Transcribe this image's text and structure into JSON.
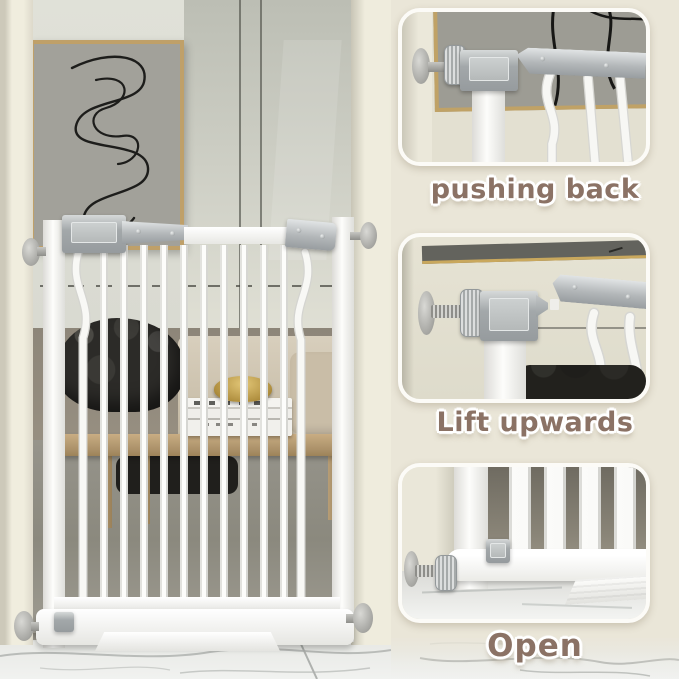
{
  "steps": [
    {
      "id": "pushing-back",
      "label": "pushing back"
    },
    {
      "id": "lift-upwards",
      "label": "Lift upwards"
    },
    {
      "id": "open",
      "label": "Open"
    }
  ],
  "colors": {
    "page_background": "#eae6d8",
    "label_text": "#8b7265",
    "label_outline": "#ffffff",
    "panel_border": "#fcfbf7",
    "gate_white": "#f8f8f5",
    "hardware_gray": "#aab0b2",
    "frame_gold": "#bfa069",
    "art_canvas": "#a2a19a",
    "mirror_gray": "#c6c8be",
    "wall_cream": "#ece9db",
    "sofa_dark": "#2c2b28",
    "sofa_beige": "#cdc3ae",
    "table_wood": "#b79d75",
    "marble_white": "#eef0ee"
  }
}
